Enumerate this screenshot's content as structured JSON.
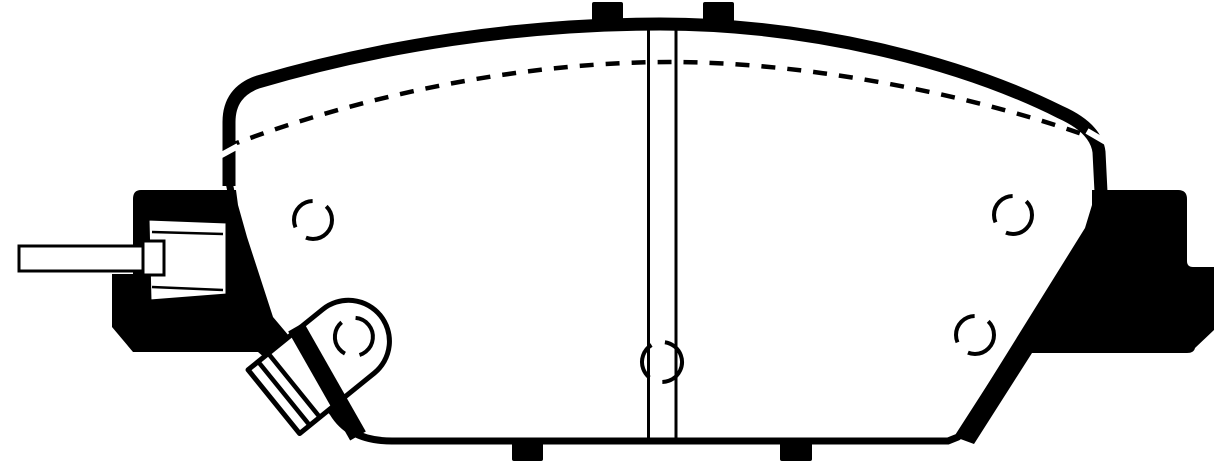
{
  "image": {
    "kind": "technical-line-drawing",
    "subject": "disc-brake-pad-outline",
    "background_color": "#ffffff",
    "ink_color": "#000000",
    "width_px": 1214,
    "height_px": 463
  },
  "drawing": {
    "viewBox": "0 0 1214 463",
    "elements": [
      {
        "tag": "path",
        "name": "pad-body-outline",
        "attrs": {
          "d": "M 229,182 L 229,122 Q 229,92 258,82 C 380,46 520,24 660,24 C 810,24 960,62 1060,112 Q 1096,128 1099,152 L 1101,196 L 1090,232 L 958,437 L 948,441 L 392,441 Q 350,441 333,413 L 289,360 L 262,345 Z",
          "fill": "#ffffff",
          "stroke": "#000000",
          "stroke-width": "7",
          "stroke-linejoin": "round"
        }
      },
      {
        "tag": "rect",
        "name": "top-tab-left",
        "attrs": {
          "x": "592",
          "y": "2",
          "width": "31",
          "height": "28",
          "rx": "2",
          "fill": "#000000"
        }
      },
      {
        "tag": "rect",
        "name": "top-tab-right",
        "attrs": {
          "x": "703",
          "y": "2",
          "width": "31",
          "height": "28",
          "rx": "2",
          "fill": "#000000"
        }
      },
      {
        "tag": "path",
        "name": "backing-plate-top-band",
        "attrs": {
          "d": "M 229,186 L 229,122 Q 229,92 258,82 C 380,46 520,24 660,24 C 810,24 960,62 1060,112 Q 1096,128 1099,152 L 1101,192",
          "fill": "none",
          "stroke": "#000000",
          "stroke-width": "13",
          "stroke-linejoin": "round",
          "stroke-linecap": "butt"
        }
      },
      {
        "tag": "rect",
        "name": "bottom-tab-left",
        "attrs": {
          "x": "512",
          "y": "440",
          "width": "31",
          "height": "21",
          "rx": "2",
          "fill": "#000000"
        }
      },
      {
        "tag": "rect",
        "name": "bottom-tab-right",
        "attrs": {
          "x": "780",
          "y": "440",
          "width": "32",
          "height": "21",
          "rx": "2",
          "fill": "#000000"
        }
      },
      {
        "tag": "path",
        "name": "right-abutment-ear",
        "attrs": {
          "d": "M 1096,190 L 1178,190 Q 1187,190 1187,199 L 1187,261 Q 1187,267 1193,267 L 1214,267 L 1214,330 L 1195,348 Q 1194,353 1187,353 L 1032,353 L 974,444 L 955,437 L 1085,228 L 1092,205 L 1092,190 Z",
          "fill": "#000000",
          "stroke": "none"
        }
      },
      {
        "tag": "path",
        "name": "left-abutment-ear",
        "attrs": {
          "d": "M 236,190 L 141,190 Q 133,190 133,199 L 133,274 L 112,274 L 112,327 L 133,352 L 258,352 L 300,388 L 316,368 L 273,317 L 247,237 L 238,205 Z",
          "fill": "#000000",
          "stroke": "none"
        }
      },
      {
        "tag": "path",
        "name": "sensor-clip-body",
        "attrs": {
          "d": "M 148,219 L 227,222 L 227,295 L 150,301 Z",
          "fill": "#ffffff",
          "stroke": "#000000",
          "stroke-width": "3",
          "stroke-linejoin": "round"
        }
      },
      {
        "tag": "path",
        "name": "sensor-clip-fold-top",
        "attrs": {
          "d": "M 152,232 L 223,234",
          "fill": "none",
          "stroke": "#000000",
          "stroke-width": "2.5"
        }
      },
      {
        "tag": "path",
        "name": "sensor-clip-fold-bottom",
        "attrs": {
          "d": "M 152,287 L 223,290",
          "fill": "none",
          "stroke": "#000000",
          "stroke-width": "2.5"
        }
      },
      {
        "tag": "rect",
        "name": "sensor-rod",
        "attrs": {
          "x": "19",
          "y": "246",
          "width": "129",
          "height": "25",
          "fill": "#ffffff",
          "stroke": "#000000",
          "stroke-width": "3"
        }
      },
      {
        "tag": "rect",
        "name": "sensor-rod-cap",
        "attrs": {
          "x": "143",
          "y": "241",
          "width": "21",
          "height": "34",
          "fill": "#ffffff",
          "stroke": "#000000",
          "stroke-width": "3"
        }
      },
      {
        "tag": "g",
        "name": "wear-indicator-tab",
        "attrs": {
          "transform": "translate(350,340) rotate(-39)"
        },
        "children": [
          {
            "tag": "path",
            "name": "wear-tab-body",
            "attrs": {
              "d": "M -98,-41 L -2,-41 A 41,41 0 0 1 -2,41 L -98,41 Z",
              "fill": "#ffffff",
              "stroke": "#000000",
              "stroke-width": "5",
              "stroke-linejoin": "round"
            }
          },
          {
            "tag": "path",
            "name": "wear-tab-stripe-1",
            "attrs": {
              "d": "M -85,-40 L -85,40",
              "fill": "none",
              "stroke": "#000000",
              "stroke-width": "4.5"
            }
          },
          {
            "tag": "path",
            "name": "wear-tab-stripe-2",
            "attrs": {
              "d": "M -72,-40.5 L -72,40.5",
              "fill": "none",
              "stroke": "#000000",
              "stroke-width": "4.5"
            }
          },
          {
            "tag": "circle",
            "name": "wear-tab-hole",
            "attrs": {
              "cx": "5",
              "cy": "0",
              "r": "19",
              "fill": "none",
              "stroke": "#000000",
              "stroke-width": "4",
              "stroke-dasharray": "37 15 37 15"
            }
          }
        ]
      },
      {
        "tag": "path",
        "name": "outline-band-over-tab",
        "attrs": {
          "d": "M 296,327 L 358,436",
          "fill": "none",
          "stroke": "#000000",
          "stroke-width": "18",
          "stroke-linecap": "butt"
        }
      },
      {
        "tag": "path",
        "name": "center-slot-line-left",
        "attrs": {
          "d": "M 648.5,27 L 648.5,440",
          "fill": "none",
          "stroke": "#000000",
          "stroke-width": "3"
        }
      },
      {
        "tag": "path",
        "name": "center-slot-line-right",
        "attrs": {
          "d": "M 676,27 L 676,440",
          "fill": "none",
          "stroke": "#000000",
          "stroke-width": "3"
        }
      },
      {
        "tag": "circle",
        "name": "center-slot-hole",
        "attrs": {
          "cx": "662",
          "cy": "362",
          "r": "20",
          "fill": "none",
          "stroke": "#000000",
          "stroke-width": "4",
          "stroke-dasharray": "38 14 38 14 22 0",
          "transform": "rotate(-20 662 362)"
        }
      },
      {
        "tag": "path",
        "name": "friction-material-dashed-line",
        "attrs": {
          "d": "M 226,147 C 380,88 540,62 670,62 C 815,62 985,98 1096,139",
          "fill": "none",
          "stroke": "#000000",
          "stroke-width": "4.5",
          "stroke-dasharray": "14 12"
        }
      },
      {
        "tag": "path",
        "name": "band-slit-left",
        "attrs": {
          "d": "M 216,158 L 238,146",
          "fill": "none",
          "stroke": "#ffffff",
          "stroke-width": "6"
        }
      },
      {
        "tag": "path",
        "name": "band-slit-right",
        "attrs": {
          "d": "M 1087,131 L 1111,145",
          "fill": "none",
          "stroke": "#ffffff",
          "stroke-width": "6"
        }
      },
      {
        "tag": "circle",
        "name": "rivet-hole-left",
        "attrs": {
          "cx": "313",
          "cy": "220",
          "r": "19",
          "fill": "none",
          "stroke": "#000000",
          "stroke-width": "4",
          "stroke-dasharray": "37 15 37 15"
        }
      },
      {
        "tag": "circle",
        "name": "rivet-hole-right-upper",
        "attrs": {
          "cx": "1013",
          "cy": "215",
          "r": "19",
          "fill": "none",
          "stroke": "#000000",
          "stroke-width": "4",
          "stroke-dasharray": "37 15 37 15"
        }
      },
      {
        "tag": "circle",
        "name": "rivet-hole-right-lower",
        "attrs": {
          "cx": "975",
          "cy": "335",
          "r": "19",
          "fill": "none",
          "stroke": "#000000",
          "stroke-width": "4",
          "stroke-dasharray": "37 15 37 15"
        }
      }
    ]
  }
}
